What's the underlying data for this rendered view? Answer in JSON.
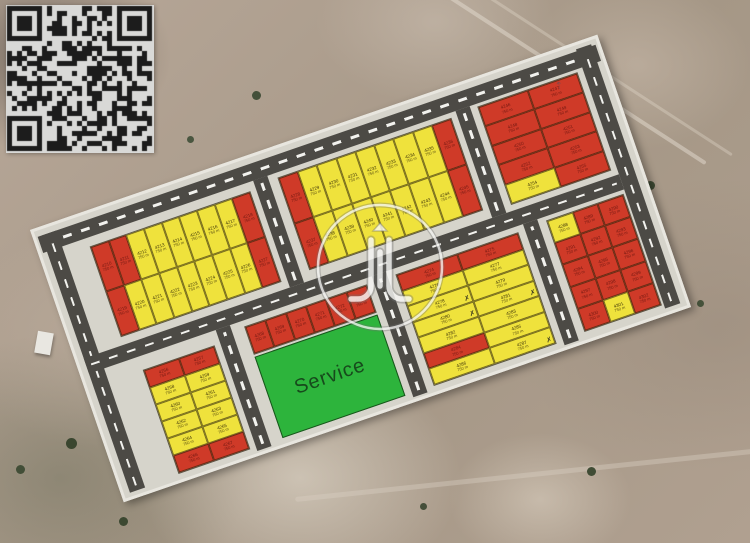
{
  "qr": {
    "label": "qr-code",
    "modules": 29
  },
  "watermark": {
    "label": "circular-logo-watermark"
  },
  "plan": {
    "service_label": "Service",
    "area_label": "750 m",
    "colors": {
      "available_yellow": "#efe23c",
      "sold_red": "#cf3a28",
      "service_green": "#2db43c",
      "road": "#4c4a45",
      "plan_background": "#d6d4cb"
    },
    "blocks": [
      {
        "id": "upperLeft",
        "cols": 9,
        "plots": [
          [
            "4210",
            "R"
          ],
          [
            "4211",
            "R"
          ],
          [
            "4212",
            "Y"
          ],
          [
            "4213",
            "Y"
          ],
          [
            "4214",
            "Y"
          ],
          [
            "4215",
            "Y"
          ],
          [
            "4216",
            "Y"
          ],
          [
            "4217",
            "Y"
          ],
          [
            "4218",
            "R"
          ],
          [
            "4219",
            "R"
          ],
          [
            "4220",
            "Y"
          ],
          [
            "4221",
            "Y"
          ],
          [
            "4222",
            "Y"
          ],
          [
            "4223",
            "Y"
          ],
          [
            "4224",
            "Y"
          ],
          [
            "4225",
            "Y"
          ],
          [
            "4226",
            "Y"
          ],
          [
            "4227",
            "R"
          ]
        ]
      },
      {
        "id": "topMiddle",
        "cols": 9,
        "plots": [
          [
            "4228",
            "R"
          ],
          [
            "4229",
            "Y"
          ],
          [
            "4230",
            "Y"
          ],
          [
            "4231",
            "Y"
          ],
          [
            "4232",
            "Y"
          ],
          [
            "4233",
            "Y"
          ],
          [
            "4234",
            "Y"
          ],
          [
            "4235",
            "Y"
          ],
          [
            "4236",
            "R"
          ],
          [
            "4237",
            "R"
          ],
          [
            "4238",
            "Y"
          ],
          [
            "4239",
            "Y"
          ],
          [
            "4240",
            "Y"
          ],
          [
            "4241",
            "Y"
          ],
          [
            "4242",
            "Y"
          ],
          [
            "4243",
            "Y"
          ],
          [
            "4244",
            "Y"
          ],
          [
            "4245",
            "R"
          ]
        ]
      },
      {
        "id": "topRight",
        "cols": 2,
        "plots": [
          [
            "4246",
            "R"
          ],
          [
            "4247",
            "R"
          ],
          [
            "4248",
            "R"
          ],
          [
            "4249",
            "R"
          ],
          [
            "4250",
            "R"
          ],
          [
            "4251",
            "R"
          ],
          [
            "4252",
            "R"
          ],
          [
            "4253",
            "R"
          ],
          [
            "4254",
            "Y"
          ],
          [
            "4255",
            "R"
          ]
        ]
      },
      {
        "id": "lowerLeft",
        "cols": 2,
        "plots": [
          [
            "4256",
            "R"
          ],
          [
            "4257",
            "R"
          ],
          [
            "4258",
            "Y"
          ],
          [
            "4259",
            "Y"
          ],
          [
            "4260",
            "Y"
          ],
          [
            "4261",
            "Y"
          ],
          [
            "4262",
            "Y"
          ],
          [
            "4263",
            "Y"
          ],
          [
            "4264",
            "Y"
          ],
          [
            "4265",
            "Y"
          ],
          [
            "4266",
            "R"
          ],
          [
            "4267",
            "R"
          ]
        ]
      },
      {
        "id": "serviceStrip",
        "cols": 6,
        "plots": [
          [
            "4268",
            "R"
          ],
          [
            "4269",
            "R"
          ],
          [
            "4270",
            "R"
          ],
          [
            "4271",
            "R"
          ],
          [
            "4272",
            "R"
          ],
          [
            "4273",
            "R"
          ]
        ]
      },
      {
        "id": "middle",
        "cols": 2,
        "plots": [
          [
            "4274",
            "R"
          ],
          [
            "4275",
            "R"
          ],
          [
            "4276",
            "Y"
          ],
          [
            "4277",
            "Y"
          ],
          [
            "4278",
            "Y",
            "m"
          ],
          [
            "4279",
            "Y"
          ],
          [
            "4280",
            "Y",
            "m"
          ],
          [
            "4281",
            "Y",
            "m"
          ],
          [
            "4282",
            "Y"
          ],
          [
            "4283",
            "Y"
          ],
          [
            "4284",
            "R"
          ],
          [
            "4285",
            "Y"
          ],
          [
            "4286",
            "Y"
          ],
          [
            "4287",
            "Y",
            "m"
          ]
        ]
      },
      {
        "id": "bottomRight",
        "cols": 3,
        "plots": [
          [
            "4288",
            "Y"
          ],
          [
            "4289",
            "R"
          ],
          [
            "4290",
            "R"
          ],
          [
            "4291",
            "R"
          ],
          [
            "4292",
            "R"
          ],
          [
            "4293",
            "R"
          ],
          [
            "4294",
            "R"
          ],
          [
            "4295",
            "R"
          ],
          [
            "4296",
            "R"
          ],
          [
            "4297",
            "R"
          ],
          [
            "4298",
            "R"
          ],
          [
            "4299",
            "R"
          ],
          [
            "4300",
            "R"
          ],
          [
            "4301",
            "Y"
          ],
          [
            "4302",
            "R"
          ]
        ]
      }
    ]
  }
}
